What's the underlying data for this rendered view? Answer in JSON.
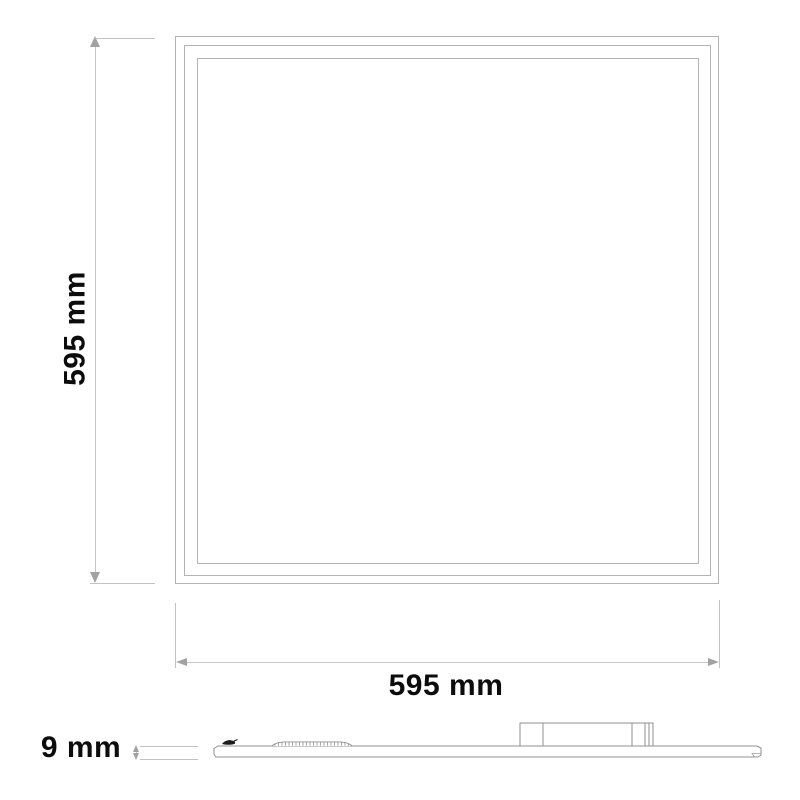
{
  "diagram": {
    "type": "technical-dimension-drawing",
    "subject": "flat square LED panel light, front view and side profile view",
    "front_view": {
      "height_dimension": {
        "label": "595 mm"
      },
      "width_dimension": {
        "label": "595 mm"
      }
    },
    "side_view": {
      "thickness_dimension": {
        "label": "9 mm"
      }
    },
    "colors": {
      "background": "#ffffff",
      "panel_outline": "#b3b3b3",
      "dimension_line": "#c6c6c6",
      "extension_line": "#c2c2c2",
      "arrowhead": "#a2a2a2",
      "side_profile_outline": "#909090",
      "label_text": "#0c0c0c"
    }
  }
}
